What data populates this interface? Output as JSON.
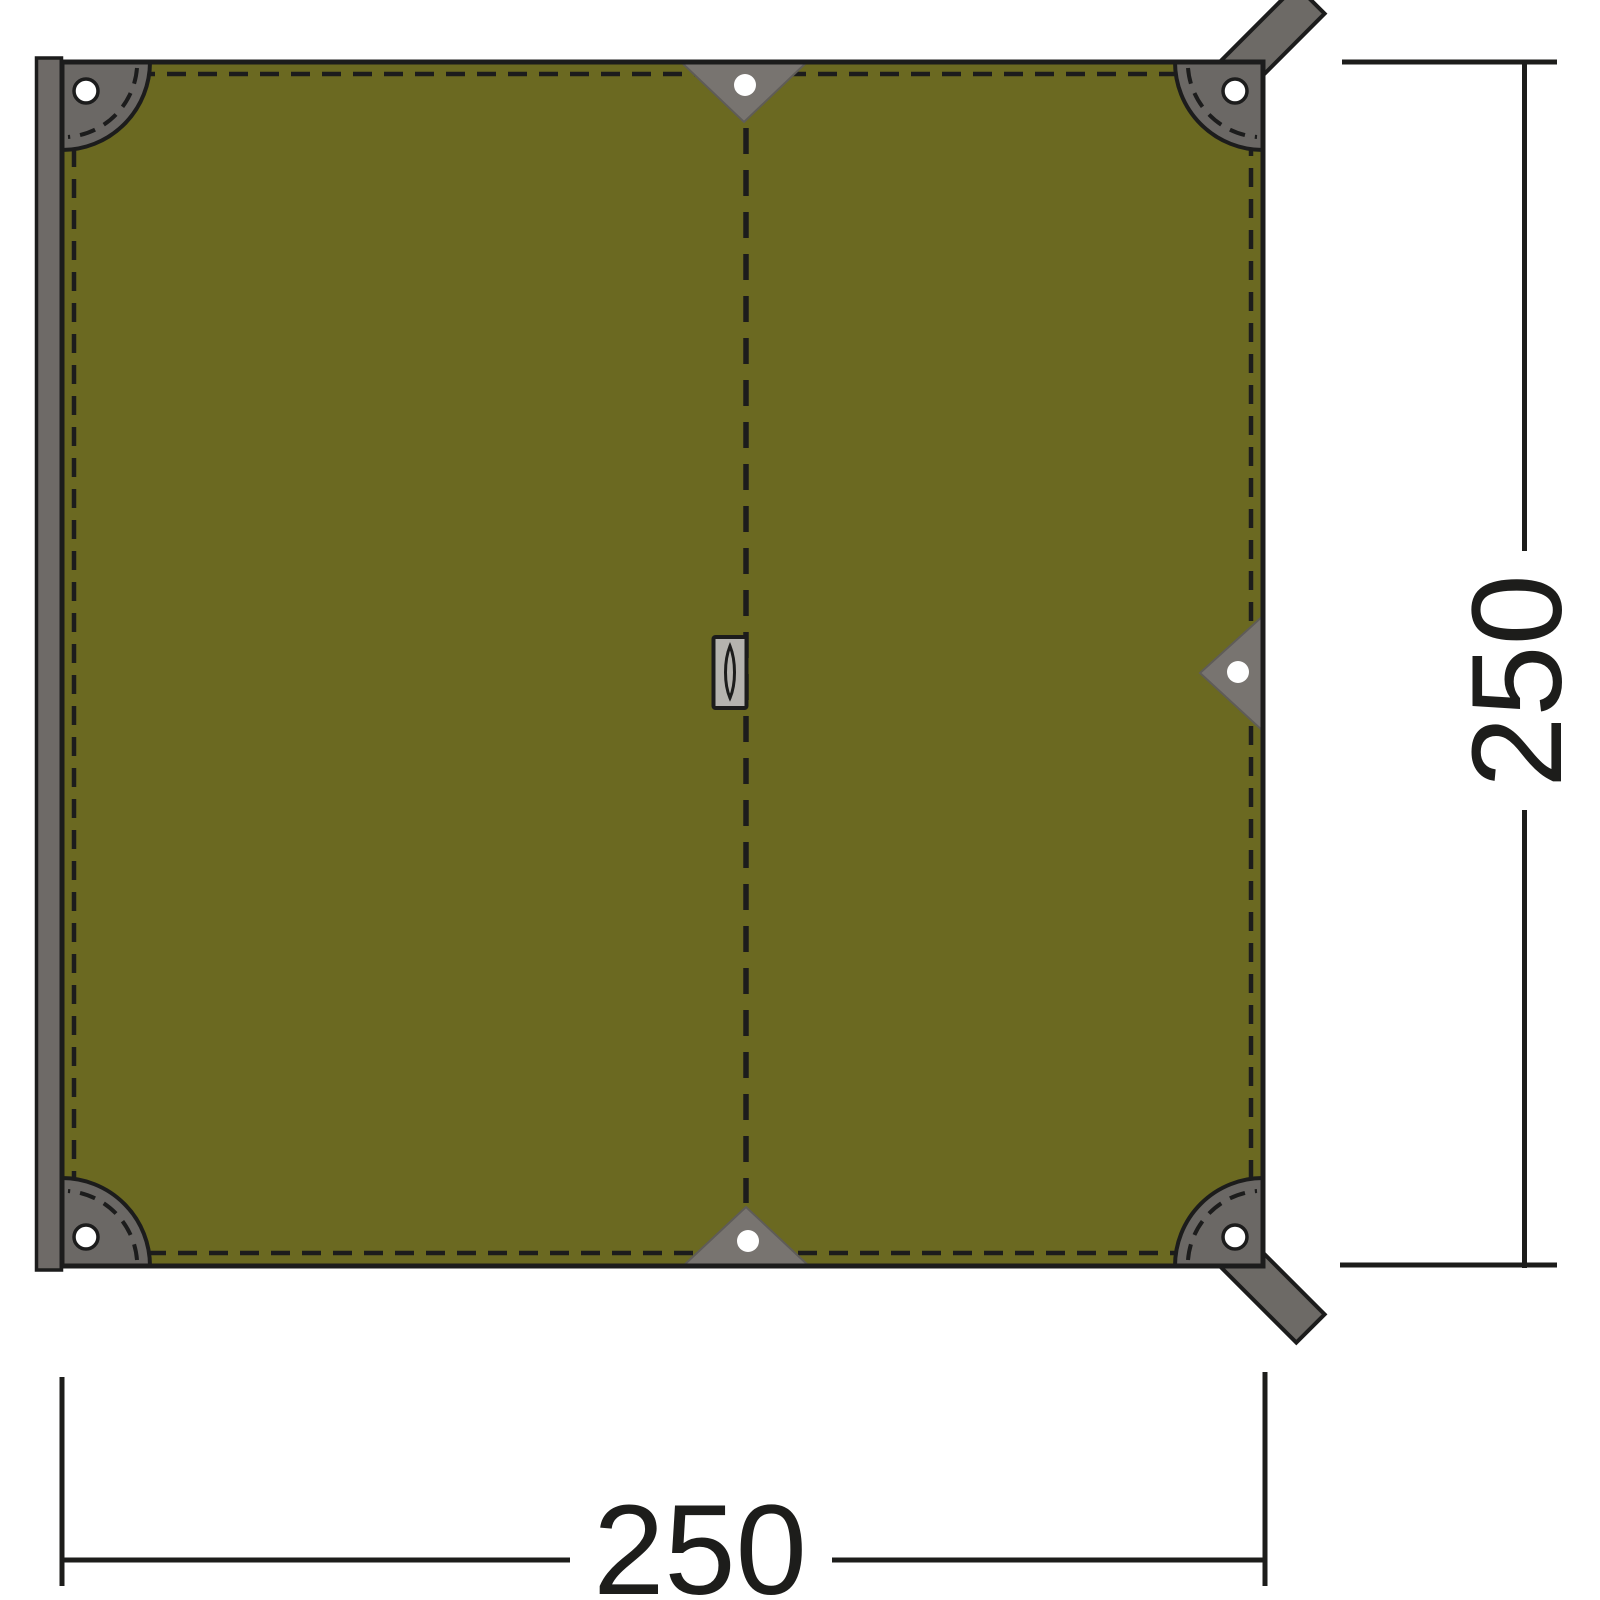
{
  "diagram": {
    "kind": "tarp top-view dimension drawing",
    "dimensions": {
      "width_label": "250",
      "height_label": "250"
    }
  },
  "colors": {
    "background": "#ffffff",
    "tarp_green": "#6b6921",
    "outline": "#1c1c1c",
    "patch_gray": "#6b6865",
    "triangle_gray": "#787470",
    "strap_gray": "#6d6a66",
    "edge_bar_gray": "#6e6a67",
    "slot_gray": "#b5b3af",
    "grommet_white": "#ffffff",
    "dimension": "#1d1d1b"
  }
}
